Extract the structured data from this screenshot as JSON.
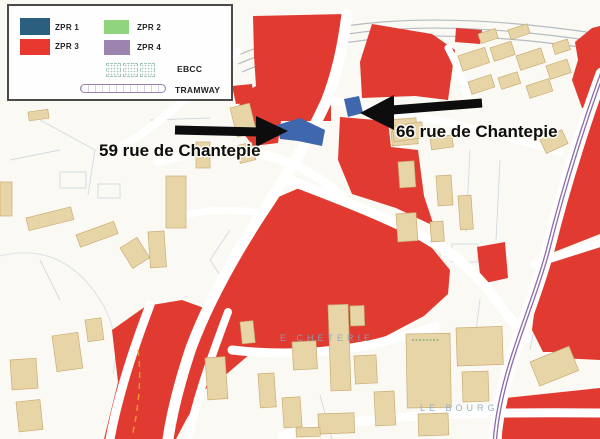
{
  "legend": {
    "items": [
      {
        "id": "zpr1",
        "label": "ZPR 1",
        "color": "#2b5f80"
      },
      {
        "id": "zpr2",
        "label": "ZPR 2",
        "color": "#90d57e"
      },
      {
        "id": "zpr3",
        "label": "ZPR 3",
        "color": "#e8382f"
      },
      {
        "id": "zpr4",
        "label": "ZPR 4",
        "color": "#9d84ae"
      },
      {
        "id": "ebcc",
        "label": "EBCC"
      },
      {
        "id": "tramway",
        "label": "TRAMWAY"
      }
    ]
  },
  "annotations": {
    "label_59": "59 rue de Chantepie",
    "label_66": "66 rue de Chantepie"
  },
  "map_texts": {
    "district": "E CHETERIE",
    "bourg": "LE BOURG"
  },
  "colors": {
    "zpr1": "#2b5f80",
    "zpr2": "#90d57e",
    "zpr3": "#e03a31",
    "zpr3-legend": "#e8382f",
    "zpr4": "#9d84ae",
    "map-blue": "#3e67ae",
    "tan": "#e8d5a7",
    "tan-edge": "#c9ad74",
    "tram": "#8f6fa8",
    "arrow": "#0d0d0d"
  }
}
